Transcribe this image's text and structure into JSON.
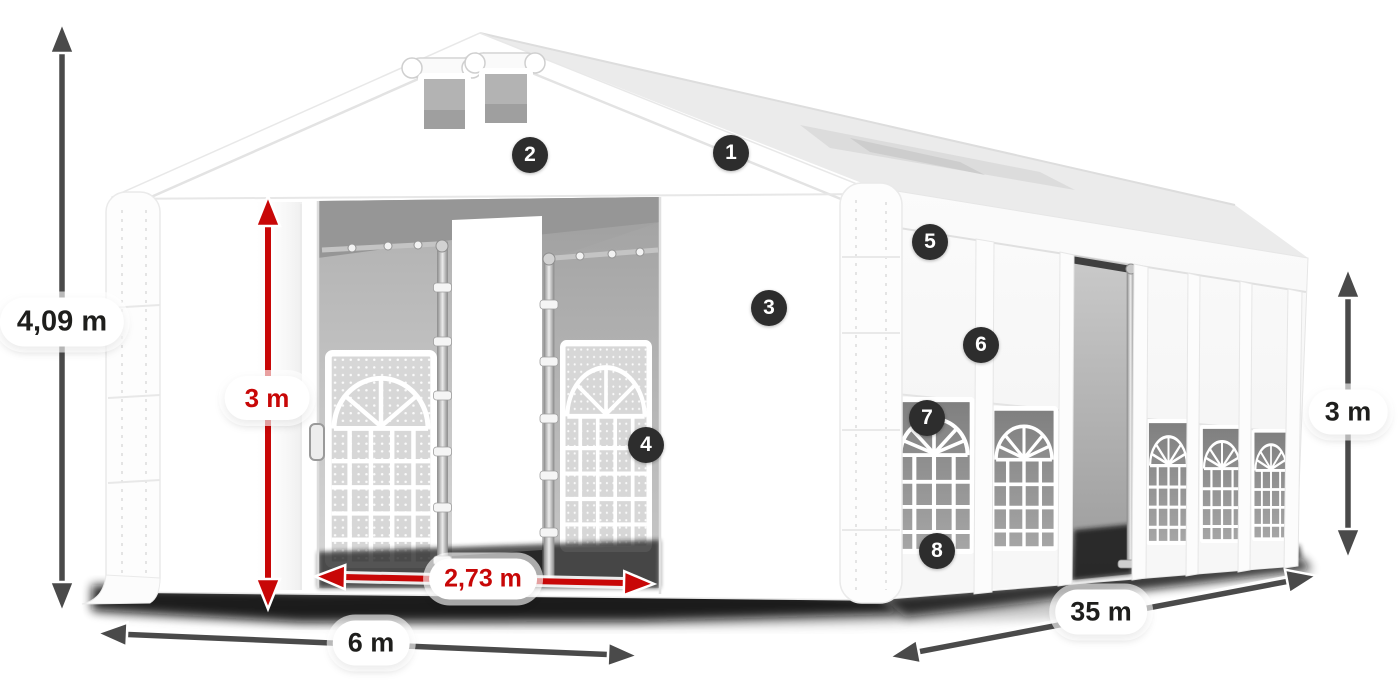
{
  "illustration": {
    "subject": "white-storage-tent",
    "view": "3d-product-render"
  },
  "dimensions": [
    {
      "id": "total-height",
      "label": "4,09 m",
      "style": "dark",
      "orientation": "vertical"
    },
    {
      "id": "entrance-height",
      "label": "3 m",
      "style": "red",
      "orientation": "vertical"
    },
    {
      "id": "entrance-width",
      "label": "2,73 m",
      "style": "red",
      "orientation": "horizontal"
    },
    {
      "id": "front-width",
      "label": "6 m",
      "style": "dark",
      "orientation": "horizontal"
    },
    {
      "id": "side-length",
      "label": "35 m",
      "style": "dark",
      "orientation": "diagonal"
    },
    {
      "id": "side-height",
      "label": "3 m",
      "style": "dark",
      "orientation": "vertical"
    }
  ],
  "markers": [
    {
      "label": "1"
    },
    {
      "label": "2"
    },
    {
      "label": "3"
    },
    {
      "label": "4"
    },
    {
      "label": "5"
    },
    {
      "label": "6"
    },
    {
      "label": "7"
    },
    {
      "label": "8"
    }
  ],
  "colors": {
    "background": "#ffffff",
    "dark_arrow": "#4a4a4a",
    "red_arrow": "#c80707",
    "badge_background": "#2d2d2d",
    "badge_text": "#ffffff",
    "label_background": "#ffffff",
    "label_text_dark": "#1e1e1c"
  }
}
